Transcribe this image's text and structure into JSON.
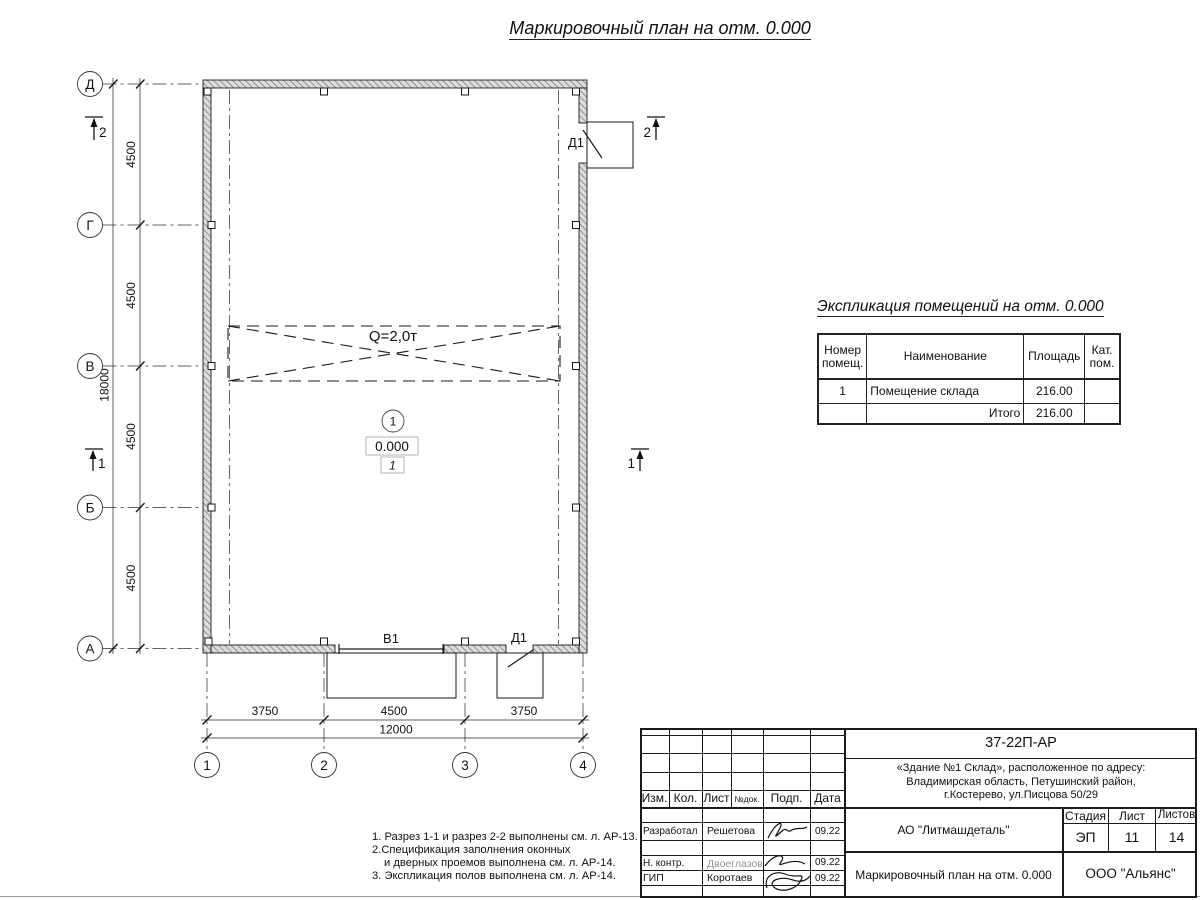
{
  "title": "Маркировочный план на отм. 0.000",
  "ink_color": "#1a1a1a",
  "wall_fill_color": "#dcdcdc",
  "plan": {
    "crane_label": "Q=2,0т",
    "room_number": "1",
    "elevation_mark": "0.000",
    "floor_type_mark": "1",
    "gate_label": "В1",
    "door_label_top": "Д1",
    "door_label_bottom": "Д1",
    "axes_rows": [
      "Д",
      "Г",
      "В",
      "Б",
      "А"
    ],
    "axes_cols": [
      "1",
      "2",
      "3",
      "4"
    ],
    "dims_left": [
      "4500",
      "4500",
      "4500",
      "4500"
    ],
    "dim_left_total": "18000",
    "dims_bottom": [
      "3750",
      "4500",
      "3750"
    ],
    "dim_bottom_total": "12000",
    "section_2": "2",
    "section_1": "1"
  },
  "explication": {
    "title": "Экспликация помещений на отм. 0.000",
    "headers": [
      "Номер помещ.",
      "Наименование",
      "Площадь",
      "Кат. пом."
    ],
    "rows": [
      [
        "1",
        "Помещение склада",
        "216.00",
        ""
      ]
    ],
    "total_label": "Итого",
    "total_value": "216.00"
  },
  "notes": {
    "line1": "1. Разрез 1-1 и разрез 2-2 выполнены см. л. АР-13.",
    "line2": "2.Спецификация заполнения оконных",
    "line3": "и дверных проемов выполнена см. л. АР-14.",
    "line4": "3. Экспликация полов выполнена см. л. АР-14."
  },
  "title_block": {
    "doc_number": "37-22П-АР",
    "address_line1": "«Здание №1 Склад», расположенное по адресу:",
    "address_line2": "Владимирская область, Петушинский район,",
    "address_line3": "г.Костерево, ул.Писцова 50/29",
    "col_izm": "Изм.",
    "col_kol": "Кол.",
    "col_list": "Лист",
    "col_ndok": "№док.",
    "col_podp": "Подп.",
    "col_data": "Дата",
    "rows": [
      {
        "role": "Разработал",
        "name": "Решетова",
        "date": "09.22"
      },
      {
        "role": "Н. контр.",
        "name": "Двоеглазов",
        "date": "09.22"
      },
      {
        "role": "ГИП",
        "name": "Коротаев",
        "date": "09.22"
      }
    ],
    "company": "АО \"Литмашдеталь\"",
    "stage_label": "Стадия",
    "stage_value": "ЭП",
    "sheet_label": "Лист",
    "sheet_value": "11",
    "sheets_label": "Листов",
    "sheets_value": "14",
    "drawing_name": "Маркировочный план на отм. 0.000",
    "org": "ООО \"Альянс\""
  }
}
